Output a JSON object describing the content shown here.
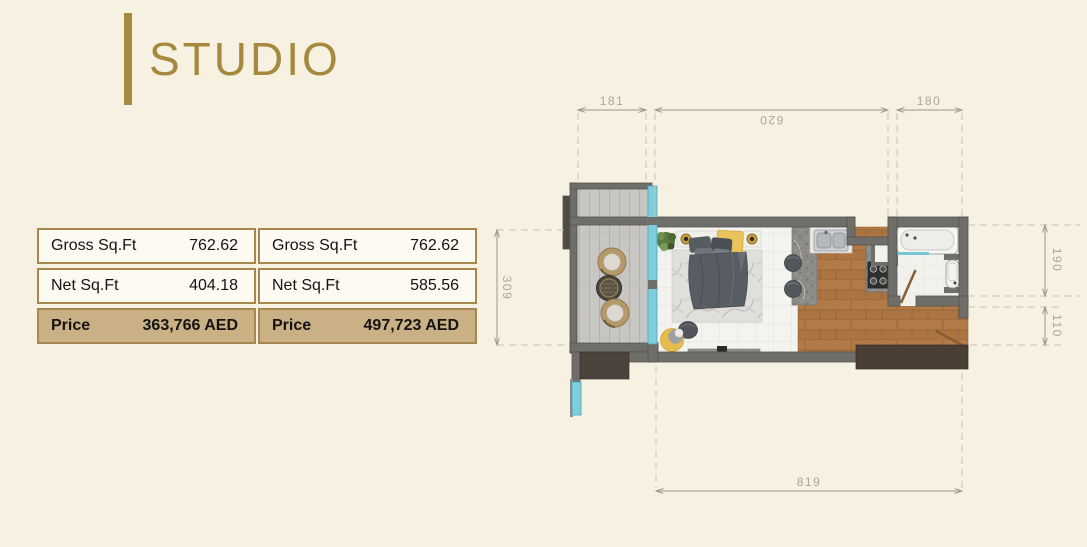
{
  "title": {
    "label": "STUDIO"
  },
  "tables": [
    {
      "rows": [
        {
          "label": "Gross Sq.Ft",
          "value": "762.62"
        },
        {
          "label": "Net Sq.Ft",
          "value": "404.18"
        },
        {
          "label": "Price",
          "value": "363,766 AED"
        }
      ]
    },
    {
      "rows": [
        {
          "label": "Gross Sq.Ft",
          "value": "762.62"
        },
        {
          "label": "Net Sq.Ft",
          "value": "585.56"
        },
        {
          "label": "Price",
          "value": "497,723 AED"
        }
      ]
    }
  ],
  "floor_plan": {
    "dimensions": {
      "balcony_width": "181",
      "unit_width": "620",
      "bathroom_width": "180",
      "balcony_depth": "309",
      "bathroom_depth": "190",
      "entry_depth": "110",
      "unit_length": "819"
    }
  },
  "colors": {
    "background": "#f7f1e1",
    "accent_gold": "#a6893f",
    "table_border": "#a8874f",
    "price_row_bg": "#c9b185",
    "row_bg": "#fdfaf2",
    "wall_gray": "#6f6e6a",
    "glass_teal": "#7ecfdb",
    "wood_floor": "#b27a46",
    "deck_gray": "#c7c6c3",
    "dimension_text": "#a9a79a"
  }
}
